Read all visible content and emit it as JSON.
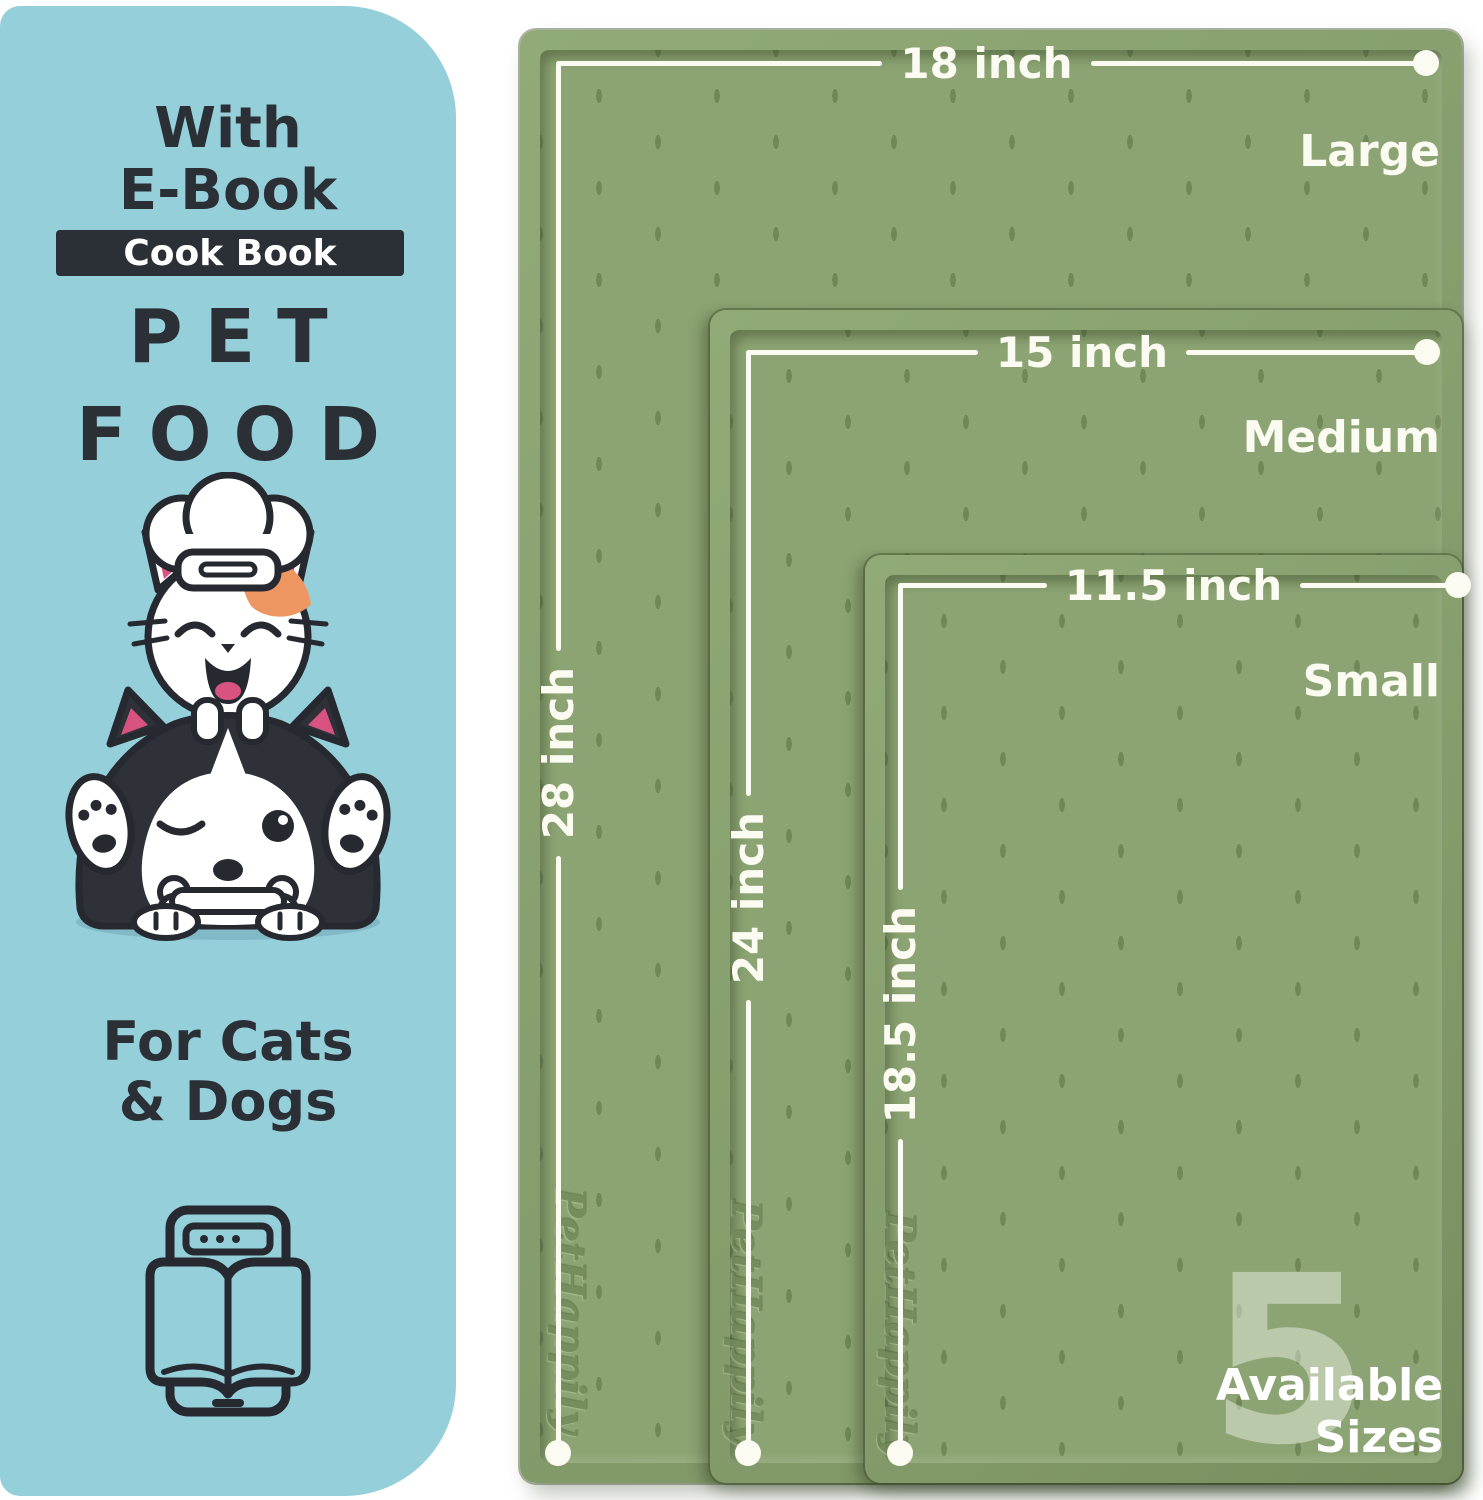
{
  "panel": {
    "bg_color": "#95cfda",
    "text_color": "#2b2f36",
    "heading_line1": "With",
    "heading_line2": "E-Book",
    "badge_label": "Cook Book",
    "title_line1": "PET",
    "title_line2": "FOOD",
    "subtitle_line1": "For Cats",
    "subtitle_line2": "& Dogs",
    "illustration": "chef-cat-on-husky-with-bone",
    "icon": "ebook-tablet-open-book"
  },
  "mats": {
    "surface_color": "#8ca473",
    "line_color": "#fbfbf2",
    "brand_embossed": "PetHappily",
    "sizes": [
      {
        "name": "Large",
        "width": "18 inch",
        "height": "28 inch"
      },
      {
        "name": "Medium",
        "width": "15 inch",
        "height": "24 inch"
      },
      {
        "name": "Small",
        "width": "11.5 inch",
        "height": "18.5 inch"
      }
    ],
    "availability": {
      "count": "5",
      "word1": "Available",
      "word2": "Sizes"
    }
  }
}
